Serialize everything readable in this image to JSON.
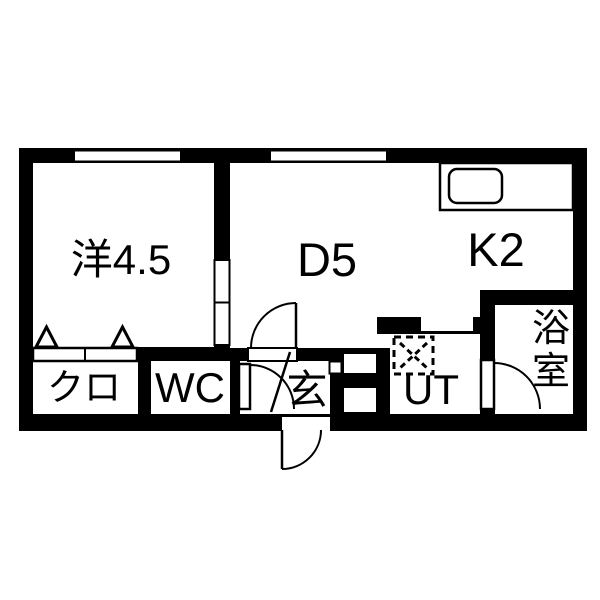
{
  "plan": {
    "type": "floor-plan",
    "rooms": {
      "western": {
        "label": "洋4.5"
      },
      "dining": {
        "label": "D5"
      },
      "kitchen": {
        "label": "K2"
      },
      "closet": {
        "label": "クロ"
      },
      "toilet": {
        "label": "WC"
      },
      "entrance": {
        "label": "玄"
      },
      "utility": {
        "label": "UT"
      },
      "bathroom": {
        "label": "浴室",
        "char_top": "浴",
        "char_bottom": "室"
      }
    },
    "fixtures": {
      "kitchen_sink": "sink-icon",
      "washing_machine_pan": "washing-machine-pan-icon",
      "closet_folding_door": "folding-door-icon",
      "sliding_door": "sliding-door-icon",
      "swing_doors": "door-swing-arc-icon",
      "windows": "window-icon"
    },
    "colors": {
      "wall": "#000000",
      "floor": "#ffffff",
      "background": "#ffffff",
      "line": "#000000"
    }
  }
}
